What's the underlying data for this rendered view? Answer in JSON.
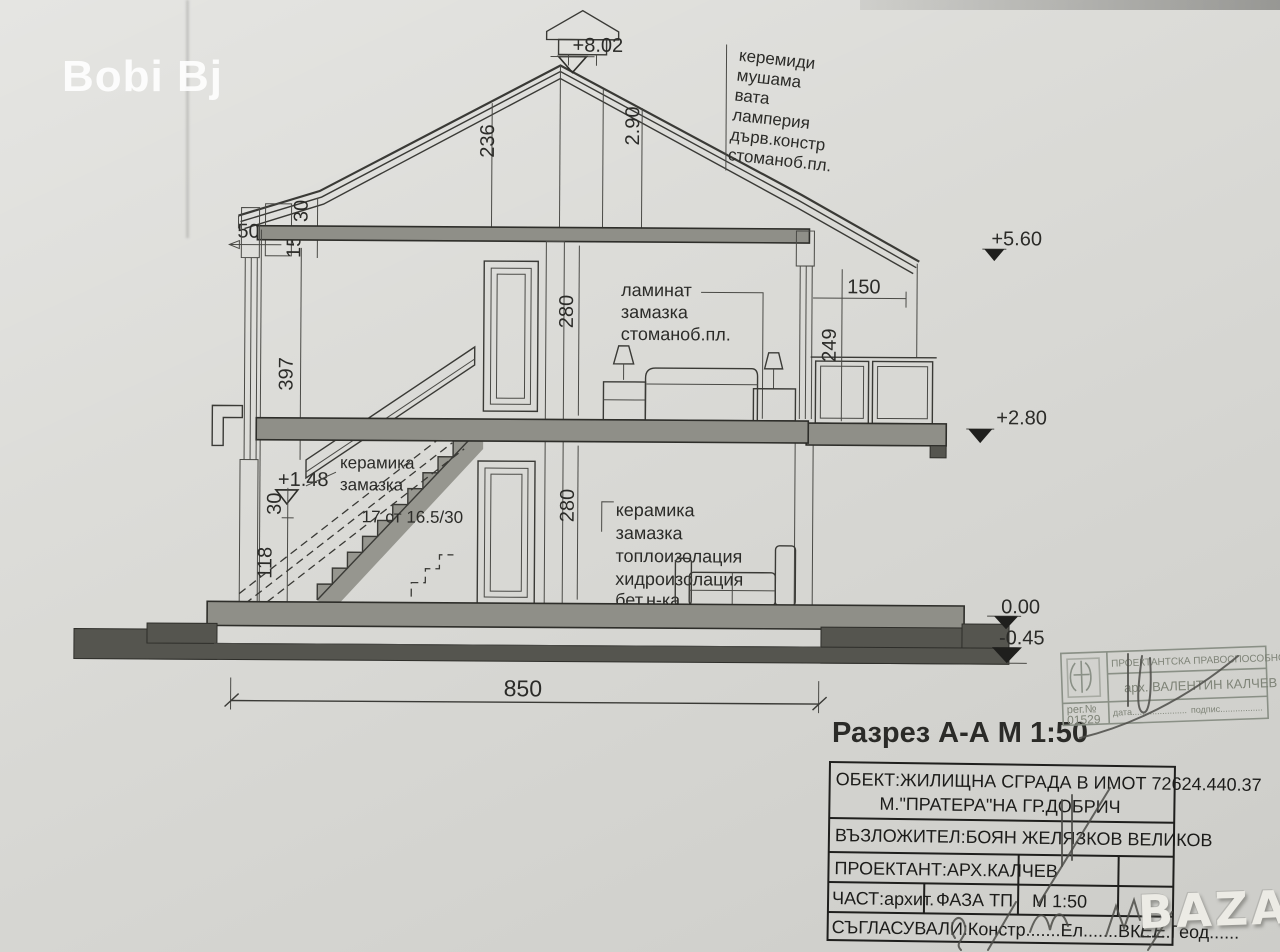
{
  "photo": {
    "credit": "Bobi Bj",
    "marketplace": "BAZAR"
  },
  "drawing": {
    "title": "Разрез А-А  М 1:50",
    "levels": {
      "ridge": "+8.02",
      "eaves": "+5.60",
      "upper_floor": "+2.80",
      "stair_landing": "+1.48",
      "ground": "0.00",
      "footing": "-0.45"
    },
    "dims": {
      "roof_height_inner": "236",
      "roof_height": "2.90",
      "eaves_overhang": "50",
      "eaves_edge": "30",
      "eaves_board": "15",
      "balcony_depth": "150",
      "balcony_rail_height": "249",
      "attic_wall_height": "397",
      "upper_room_height": "280",
      "lower_room_height": "280",
      "plinth_height": "30",
      "foundation_height": "118",
      "total_width": "850"
    },
    "stair_note": "17 ст 16.5/30",
    "notes": {
      "roof": [
        "керемиди",
        "мушама",
        "вата",
        "ламперия",
        "дърв.констр",
        "стоманоб.пл."
      ],
      "upper_floor": [
        "ламинат",
        "замазка",
        "стоманоб.пл."
      ],
      "stair_landing": [
        "керамика",
        "замазка"
      ],
      "ground_floor": [
        "керамика",
        "замазка",
        "топлоизолация",
        "хидроизолация",
        "бет.н-ка"
      ]
    }
  },
  "title_block": {
    "object_line1": "ОБЕКТ:ЖИЛИЩНА СГРАДА В ИМОТ 72624.440.37",
    "object_line2": "М.\"ПРАТЕРА\"НА ГР.ДОБРИЧ",
    "client": "ВЪЗЛОЖИТЕЛ:БОЯН ЖЕЛЯЗКОВ ВЕЛИКОВ",
    "designer": "ПРОЕКТАНТ:АРХ.КАЛЧЕВ",
    "part": "ЧАСТ:архит.",
    "phase": "ФАЗА ТП",
    "scale": "М 1:50",
    "approvals": "СЪГЛАСУВАЛИ:Констр.......Ел.......ВК......Геод......",
    "approvals_handwritten": "ЕЕ"
  },
  "stamp": {
    "header": "ПРОЕКТАНТСКА ПРАВОСПОСОБНОСТ",
    "name": "арх. ВАЛЕНТИН КАЛЧЕВ",
    "reg_label": "рег.№",
    "reg_number": "01529",
    "date_label": "дата......................",
    "signature_label": "подпис................."
  }
}
